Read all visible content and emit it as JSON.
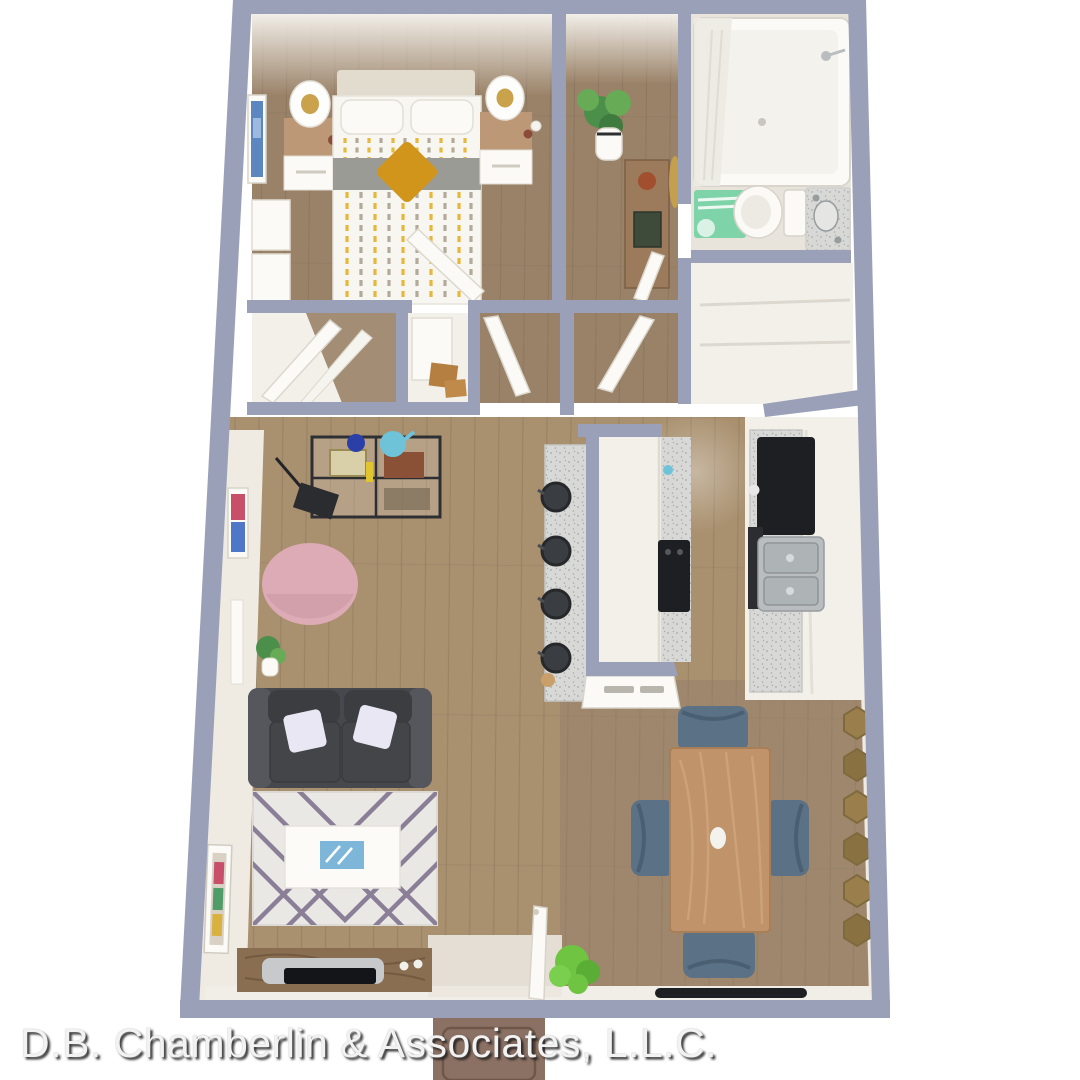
{
  "caption": {
    "text": "D.B. Chamberlin & Associates, L.L.C."
  },
  "floor_plan": {
    "type": "3d-rendered-apartment-floor-plan",
    "rooms": [
      "bedroom",
      "bathroom",
      "closet",
      "utility-closet",
      "hallway",
      "pantry",
      "kitchen",
      "kitchen-island",
      "living-room",
      "dining-area",
      "entry"
    ]
  },
  "colors": {
    "page": "#ffffff",
    "wall": "#9aa0b8",
    "wall_light": "#aeb3c6",
    "white_wall": "#f3f0ea",
    "white_bright": "#fbfaf6",
    "floor_bed": "#9a8268",
    "floor_main": "#a9906f",
    "floor_dark": "#8e7b69",
    "plank": "#6b5a47",
    "bath_floor": "#e8e4dc",
    "rug": "#eae8e4",
    "rug_stripe": "#8a7f97",
    "sofa": "#46484d",
    "sofa_dark": "#3b3d41",
    "sofa_light": "#55575c",
    "pillow_light": "#e9e7f3",
    "pouf": "#dcabb5",
    "pouf_shade": "#c997a3",
    "table_wood": "#c0936a",
    "table_wood_light": "#d2a87e",
    "chair_blue": "#5b7186",
    "chair_blue_dark": "#4b5f73",
    "console_wood": "#8a6e51",
    "console_grain": "#6e553c",
    "tv_silver": "#c7c9cb",
    "black": "#1d1f22",
    "charcoal": "#2b2d30",
    "steel": "#b9bdc0",
    "steel_dark": "#979c9f",
    "speckle": "#d8d9d7",
    "speckle_dot": "#a2a4a2",
    "duvet_white": "#f7f6f1",
    "duvet_yellow": "#e5b73d",
    "duvet_gray": "#b2aa9b",
    "duvet_band": "#9b9b96",
    "mustard": "#d1951c",
    "nightstand_wood": "#bd9877",
    "headboard": "#e2dcce",
    "teal_mat": "#7fd3a9",
    "plant_dark": "#4c8f4a",
    "plant_mid": "#67ab57",
    "plant_bright": "#6fc441",
    "accent_teal": "#6fc3d9",
    "accent_blue": "#2b3fa8",
    "tray_blue": "#7db6d9",
    "art_blue": "#5b86c0",
    "gold": "#c9a24b",
    "mirror_gold": "#9a7f4c",
    "mirror_gold_dark": "#7f6a3e",
    "box_tan": "#b57f42",
    "mat_brown": "#8b7164",
    "mat_border": "#6e5748",
    "text": "#f2f2f2",
    "text_shadow": "rgba(25,25,25,0.85)"
  }
}
